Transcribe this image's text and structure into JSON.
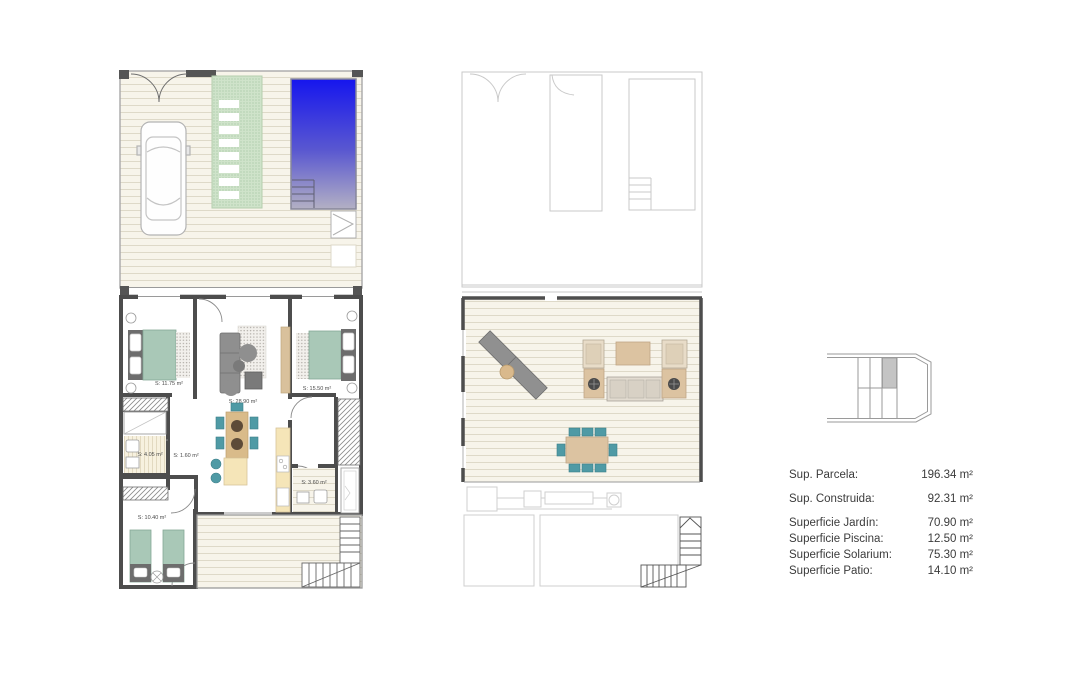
{
  "document": {
    "type": "architectural-floor-plan-sheet",
    "background": "#ffffff"
  },
  "plans": {
    "ground_floor": {
      "name": "ground-floor-plan",
      "rooms": [
        {
          "id": "bedroom-1",
          "label": "S: 11.75 m²"
        },
        {
          "id": "living-kitchen",
          "label": "S: 28.90 m²"
        },
        {
          "id": "bedroom-2",
          "label": "S: 15.50 m²"
        },
        {
          "id": "bathroom-1",
          "label": "S: 4.05 m²"
        },
        {
          "id": "hall",
          "label": "S: 1.60 m²"
        },
        {
          "id": "bathroom-2",
          "label": "S: 3.60 m²"
        },
        {
          "id": "bedroom-3",
          "label": "S: 10.40 m²"
        }
      ],
      "features": [
        "garden-deck",
        "parked-car",
        "stepping-stone-path",
        "swimming-pool",
        "pool-steps",
        "outdoor-shower",
        "entrance-gates",
        "dining-table",
        "kitchen-island",
        "kitchen-counter",
        "beds",
        "wardrobes",
        "patio-deck",
        "staircase"
      ]
    },
    "upper_floor": {
      "name": "upper-floor-solarium-plan",
      "features": [
        "ghost-outline-of-floor-below",
        "solarium-deck",
        "sun-loungers",
        "round-side-table",
        "armchairs",
        "coffee-table",
        "sofa",
        "plant-side-tables",
        "dining-table-8-chairs",
        "staircase"
      ]
    }
  },
  "key_plan": {
    "name": "site-key-plan",
    "highlighted_unit": "third-cell-top-row"
  },
  "areas": {
    "rows": [
      {
        "label": "Sup. Parcela:",
        "value": "196.34 m²"
      },
      {
        "label": "Sup. Construida:",
        "value": "92.31 m²"
      },
      {
        "label": "Superficie Jardín:",
        "value": "70.90 m²"
      },
      {
        "label": "Superficie Piscina:",
        "value": "12.50 m²"
      },
      {
        "label": "Superficie Solarium:",
        "value": "75.30 m²"
      },
      {
        "label": "Superficie Patio:",
        "value": "14.10 m²"
      }
    ]
  },
  "colors": {
    "wall_dark": "#4d4d4d",
    "wall_light": "#9a9a9a",
    "ghost_outline": "#c9c9c9",
    "deck_base": "#f7f4ea",
    "deck_line": "#ded9c8",
    "path_green": "#cfe3ca",
    "pool_blue_top": "#1616ee",
    "pool_fade_bottom": "#b3b0c4",
    "bed_green": "#a9c8b7",
    "chair_teal": "#4f9aa5",
    "wood_tan": "#dcc3a1",
    "kitchen_cream": "#f5e5b8",
    "sofa_gray": "#8f8f8f",
    "text": "#3b3b3b"
  }
}
